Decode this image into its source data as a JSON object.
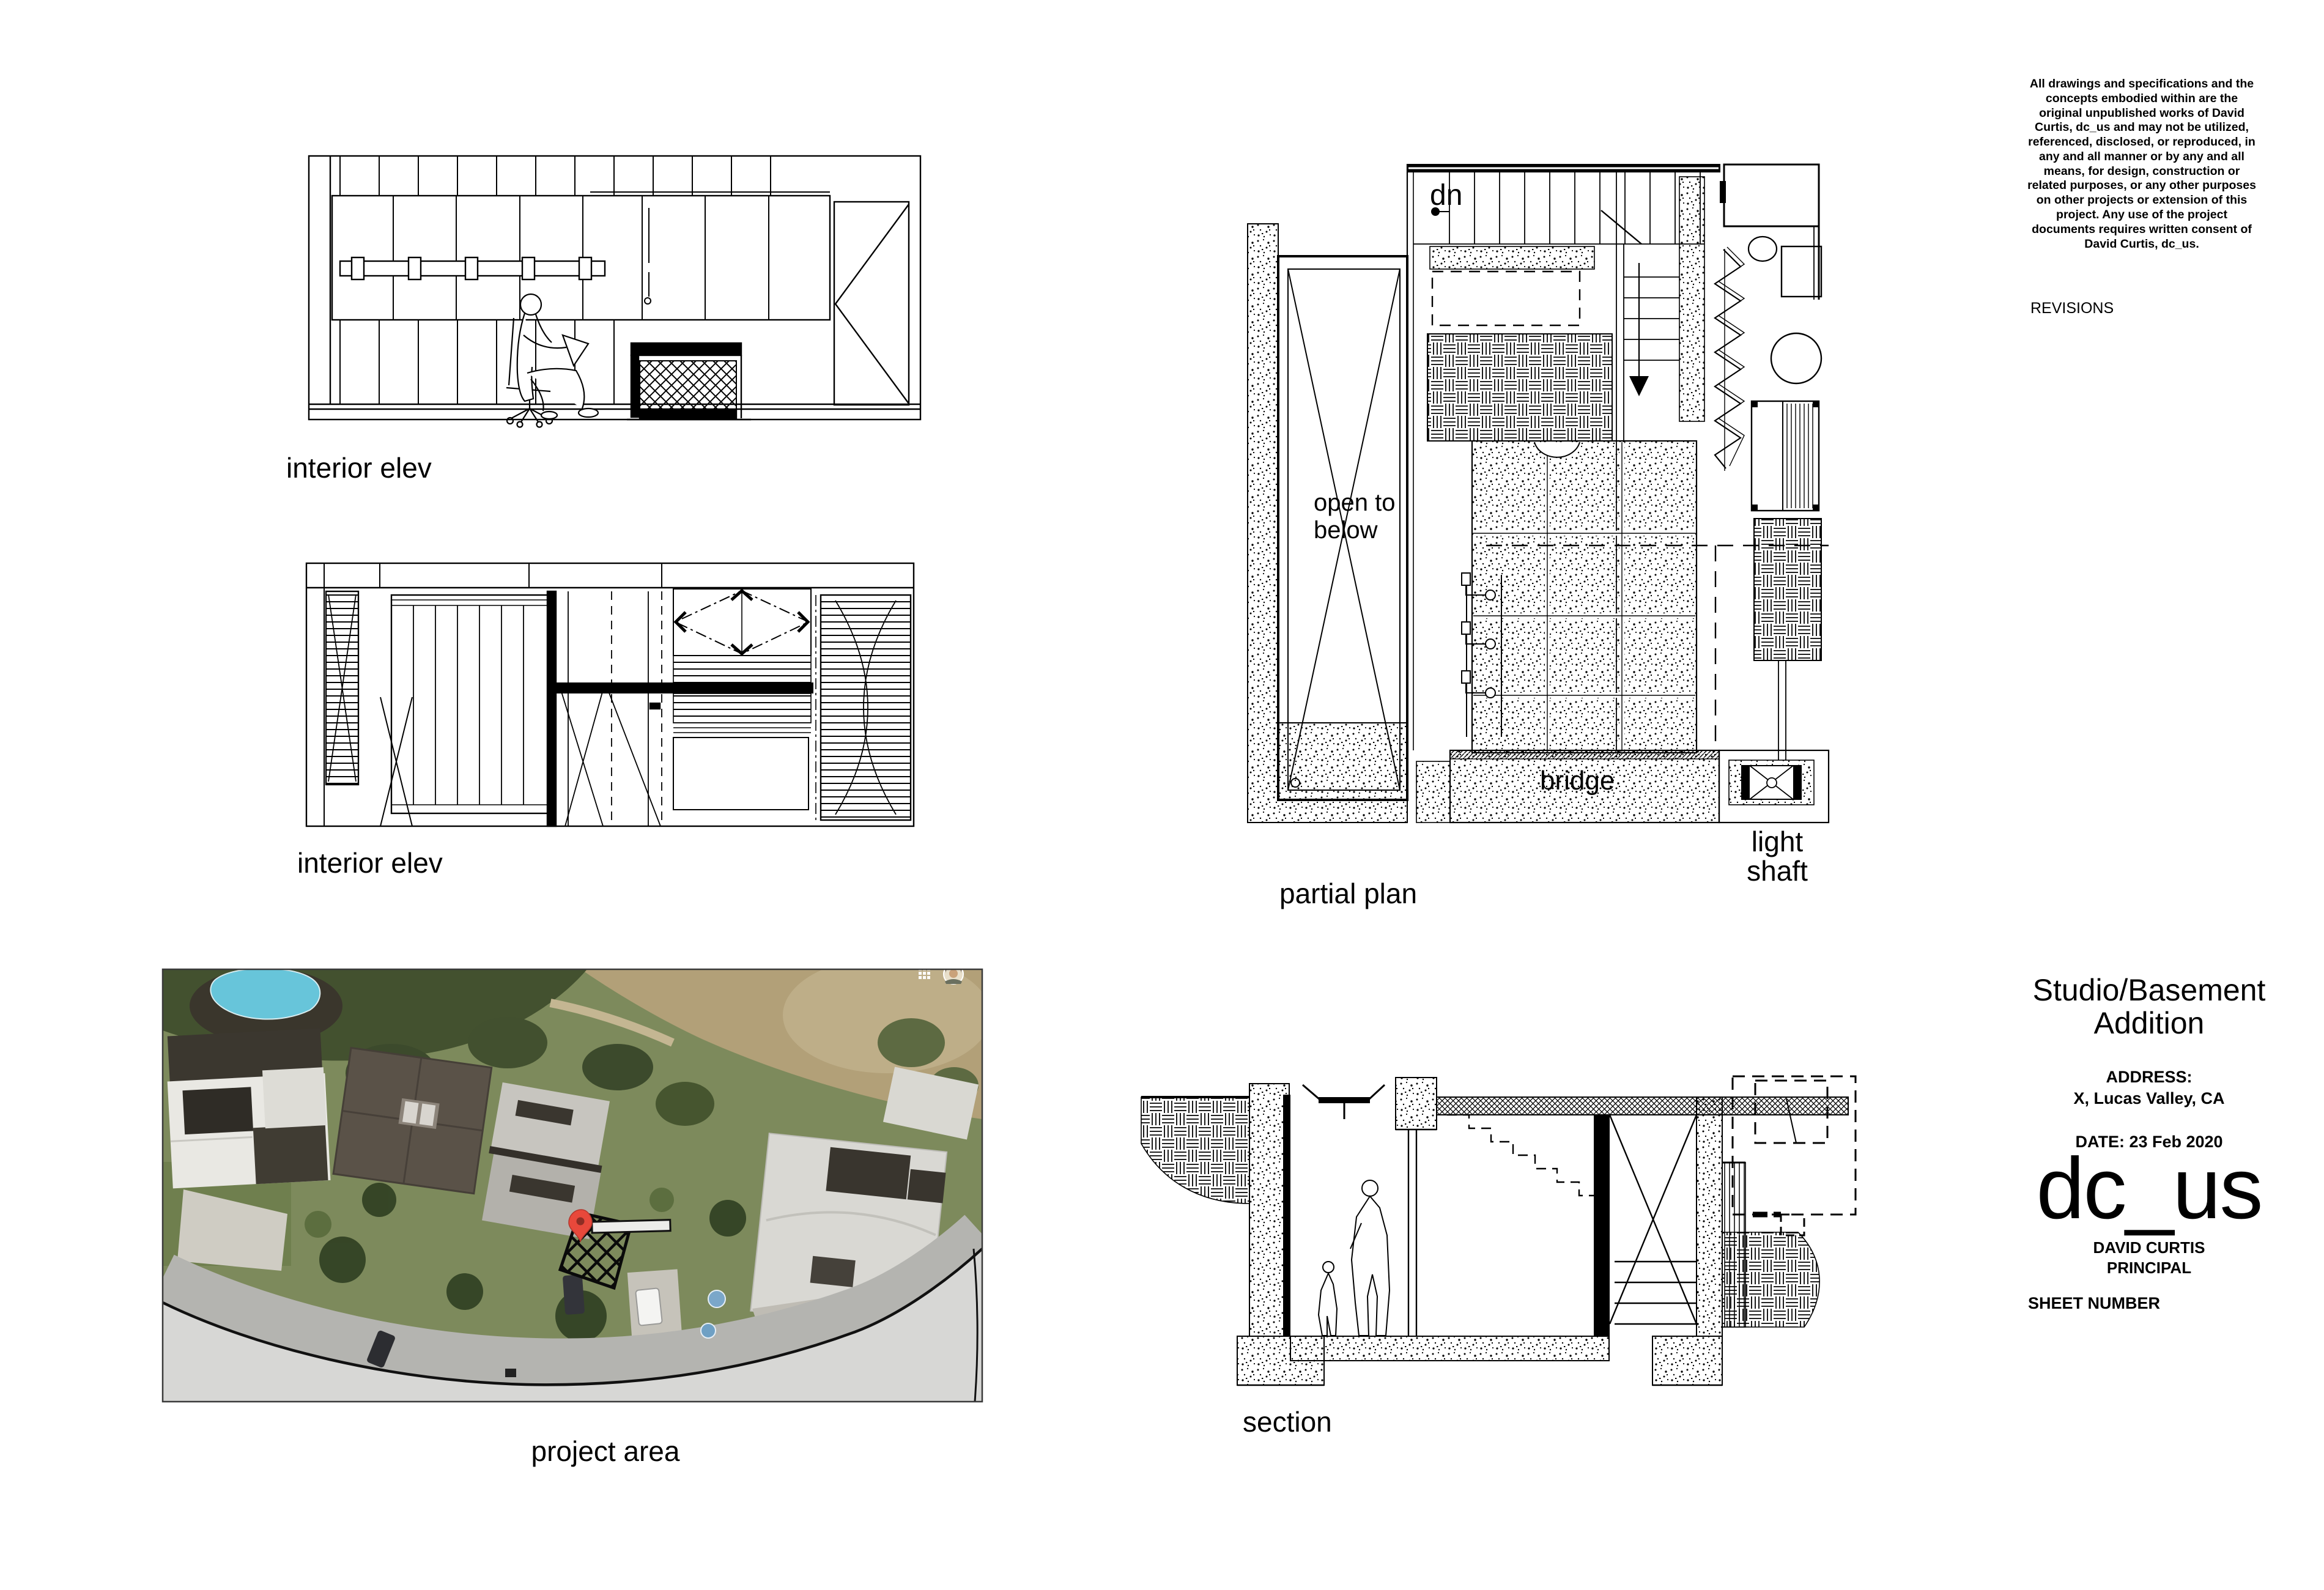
{
  "sheet": {
    "background": "#ffffff",
    "ink": "#000000"
  },
  "notes": {
    "legal": "All drawings and specifications and the concepts embodied within are the original unpublished works of David Curtis, dc_us and may not be utilized, referenced, disclosed, or reproduced, in any and all manner or by any and all means, for design, construction or related purposes, or any other purposes on other projects or extension of this project. Any use of the project documents requires written consent of David Curtis, dc_us.",
    "revisions_label": "REVISIONS"
  },
  "title_block": {
    "project_title": "Studio/Basement Addition",
    "address_label": "ADDRESS:",
    "address_value": "X, Lucas Valley, CA",
    "date": "DATE: 23 Feb 2020",
    "firm_logo": "dc_us",
    "principal_name": "DAVID CURTIS",
    "principal_role": "PRINCIPAL",
    "sheet_number_label": "SHEET NUMBER"
  },
  "drawings": {
    "interior_elev_1": {
      "label": "interior elev"
    },
    "interior_elev_2": {
      "label": "interior elev"
    },
    "partial_plan": {
      "label": "partial plan",
      "annotations": {
        "dn": "dn",
        "open_to_below": "open to below",
        "bridge": "bridge",
        "light_shaft": "light shaft"
      }
    },
    "section": {
      "label": "section"
    },
    "project_area": {
      "label": "project area"
    }
  },
  "photo": {
    "colors": {
      "vegetation_dark": "#43512f",
      "grass": "#7d8a5c",
      "dry_grass": "#b2a078",
      "pool": "#67c5da",
      "roof_dark": "#5a5248",
      "roof_light": "#d9d8d3",
      "road": "#b4b4b0",
      "overlay_gray": "#d7d7d5",
      "pin_red": "#e8483b",
      "umbrella_blue": "#7ba7c9"
    }
  }
}
